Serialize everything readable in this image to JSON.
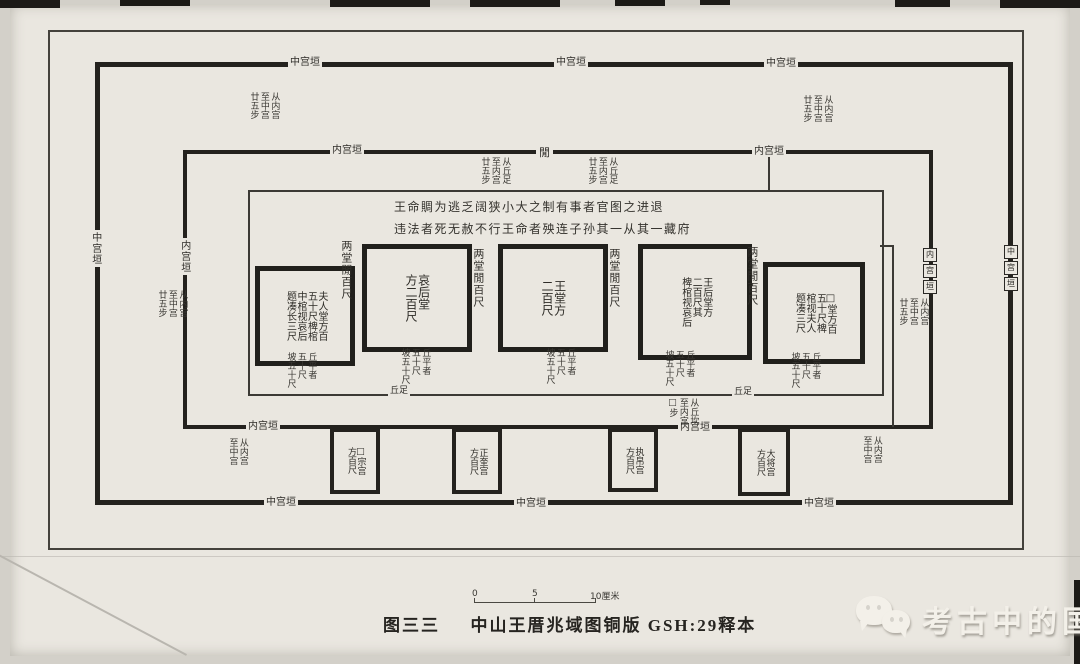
{
  "caption": {
    "fig_no": "图三三",
    "title": "中山王厝兆域图铜版 GSH:29释本"
  },
  "scale_bar": {
    "start": "0",
    "mid": "5",
    "end": "10厘米"
  },
  "watermark": {
    "text": "考古中的国",
    "icon": "wechat-icon"
  },
  "walls": {
    "middle_wall": "中宫垣",
    "inner_wall": "内宫垣",
    "middle_wall_chars": [
      "中",
      "宫",
      "垣"
    ],
    "inner_wall_chars": [
      "内",
      "宫",
      "垣"
    ],
    "gate": "閒",
    "mound_foot": "丘足"
  },
  "edict": {
    "line1": "王命賙为逃乏阔狭小大之制有事者官图之进退",
    "line2": "违法者死无赦不行王命者殃连子孙其一从其一藏府"
  },
  "halls": [
    {
      "id": "furen-hall",
      "cols": [
        "夫人堂方百",
        "五十尺椑棺",
        "中棺视哀后",
        "题凑长三尺"
      ]
    },
    {
      "id": "aihou-hall",
      "cols": [
        "哀后堂",
        "方二百尺"
      ]
    },
    {
      "id": "wang-hall",
      "cols": [
        "王堂方",
        "二百尺"
      ]
    },
    {
      "id": "wanghou-hall",
      "cols": [
        "王后堂方",
        "二百尺其",
        "椑棺视哀后"
      ]
    },
    {
      "id": "peitang-hall",
      "cols": [
        "□堂方百",
        "五十尺椑",
        "棺视夫人",
        "题凑三尺"
      ]
    }
  ],
  "hall_gap": "两堂閒百尺",
  "palaces": [
    {
      "name": "□宗宫",
      "size": "方百尺"
    },
    {
      "name": "正奎宫",
      "size": "方百尺"
    },
    {
      "name": "执帛宫",
      "size": "方百尺"
    },
    {
      "name": "大将宫",
      "size": "方百尺"
    }
  ],
  "annotations": {
    "between_walls": [
      "从内宫",
      "至中宫",
      "廿五步"
    ],
    "inner_zone": [
      "从丘足",
      "至内宫",
      "廿五步"
    ],
    "corner": [
      "从内宫",
      "至中宫"
    ],
    "mound_flat": [
      "丘平者",
      "五十尺",
      "坡五十尺"
    ],
    "below_mound": [
      "从丘坎",
      "至内宫",
      "□步"
    ]
  }
}
